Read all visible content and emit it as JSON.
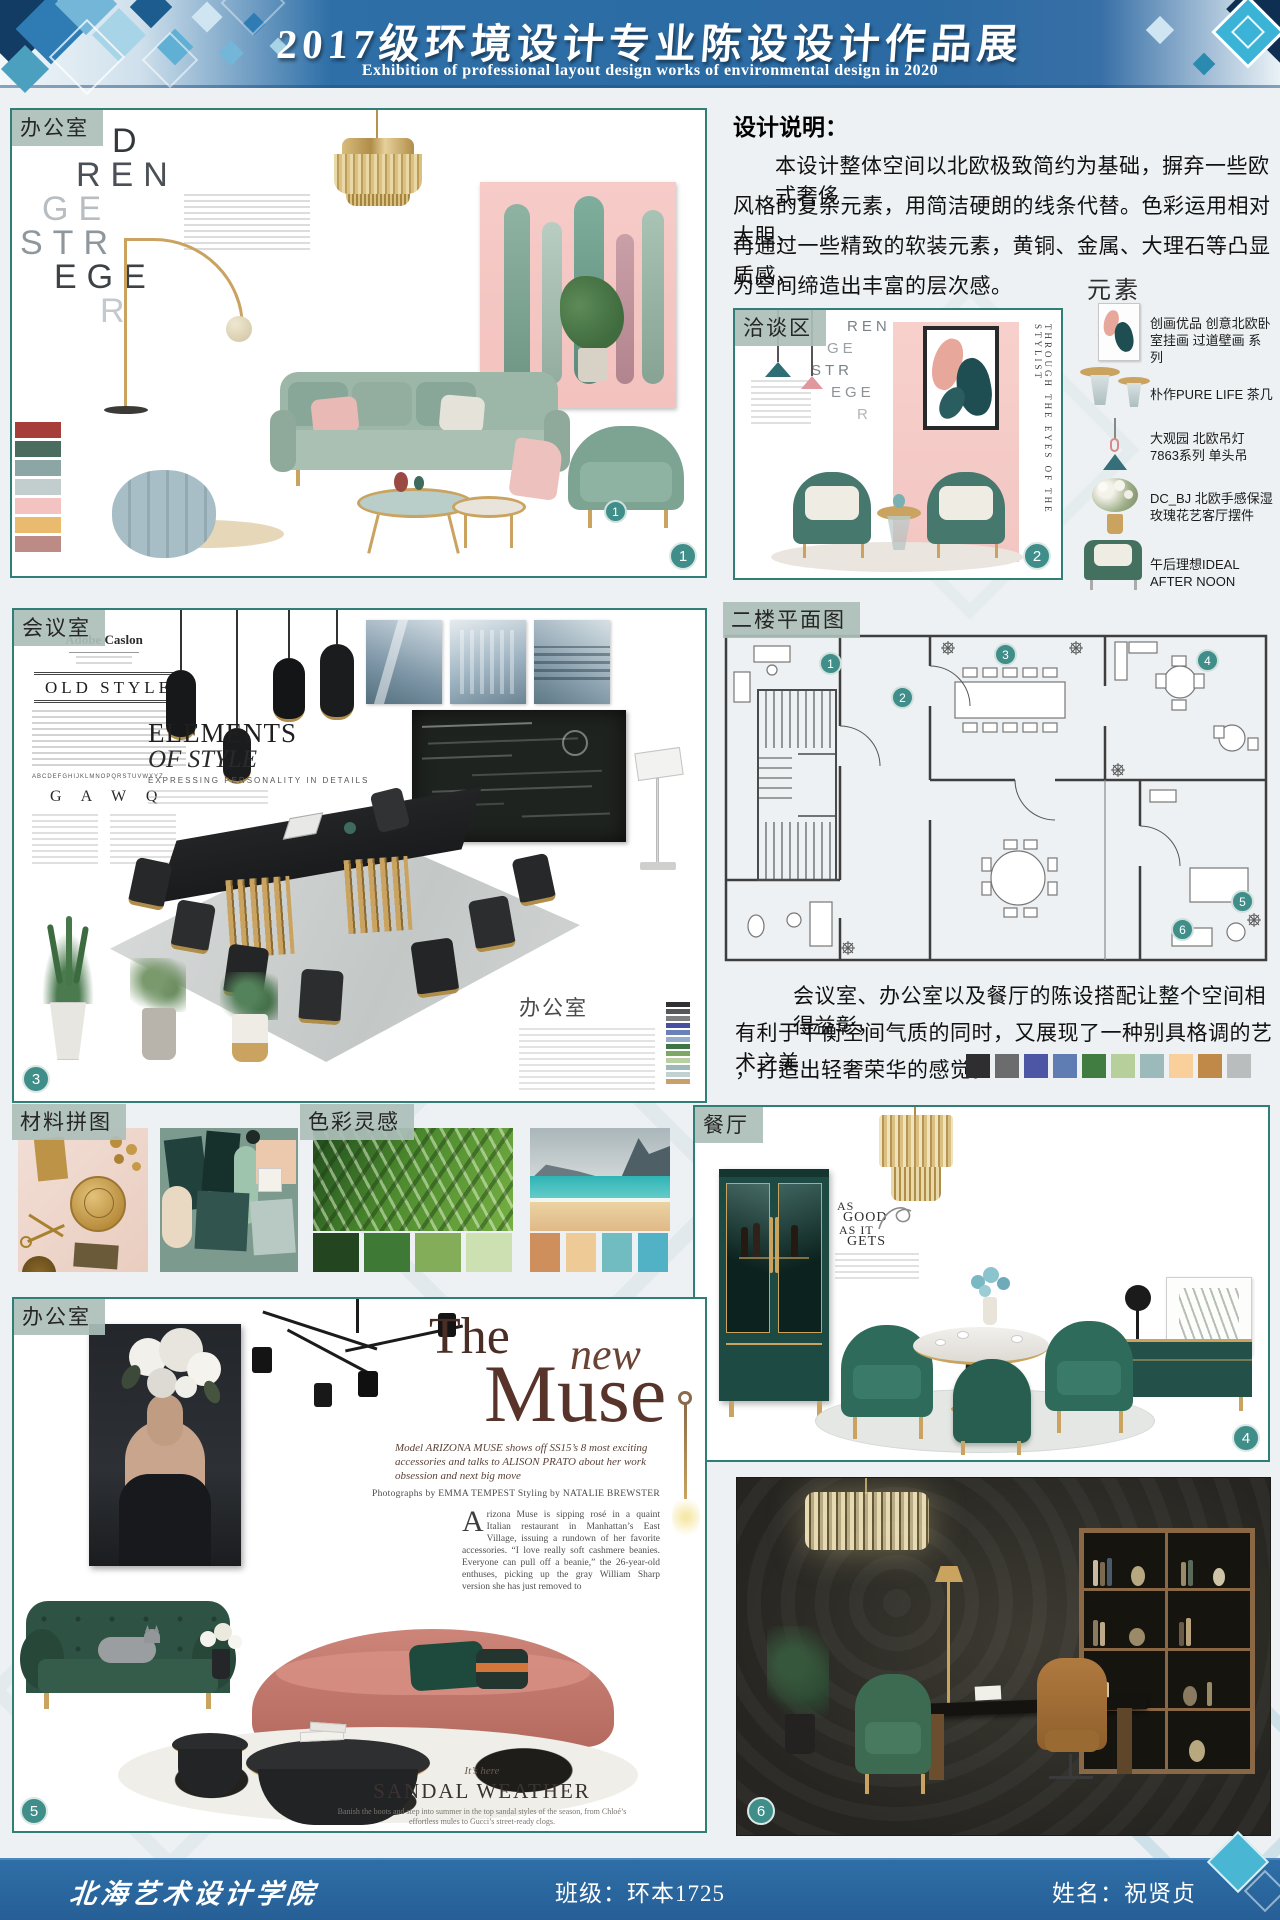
{
  "header": {
    "title": "2017级环境设计专业陈设设计作品展",
    "subtitle": "Exhibition of professional layout design works of environmental design in 2020"
  },
  "design_note": {
    "title": "设计说明：",
    "line1": "本设计整体空间以北欧极致简约为基础，摒弃一些欧式奢侈",
    "line2": "风格的复杂元素，用简洁硬朗的线条代替。色彩运用相对大胆，",
    "line3": "再通过一些精致的软装元素，黄铜、金属、大理石等凸显质感，",
    "line4": "为空间缔造出丰富的层次感。"
  },
  "office_top": {
    "label": "办公室",
    "badge": "1",
    "marker": "1",
    "letters": [
      "D",
      "REN",
      "GE",
      "STR",
      "EGE",
      "R"
    ],
    "palette": [
      "#a63d38",
      "#4b6d5f",
      "#8ba6a4",
      "#c2cecd",
      "#f2c3c1",
      "#eaba6e",
      "#bd8b85"
    ]
  },
  "negotiation": {
    "label": "洽谈区",
    "badge": "2",
    "letters": [
      "REN",
      "GE",
      "STR",
      "EGE",
      "R"
    ],
    "caption": "THROUGH THE EYES OF THE STYLIST"
  },
  "elements": {
    "title": "元素",
    "items": [
      {
        "name": "创画优品 创意北欧卧室挂画 过道壁画 系列"
      },
      {
        "name": "朴作PURE LIFE 茶几"
      },
      {
        "name": "大观园 北欧吊灯 7863系列 单头吊"
      },
      {
        "name": "DC_BJ 北欧手感保湿玫瑰花艺客厅摆件"
      },
      {
        "name": "午后理想IDEAL AFTER NOON"
      }
    ]
  },
  "meeting": {
    "label": "会议室",
    "badge": "3",
    "brand": "Adobe Caslon",
    "headline": "OLD STYLE",
    "specimen": "G A W Q",
    "alphabet": "ABCDEFGHIJKLMNOPQRSTUVWXYZ",
    "elements_line1": "ELEMENTS",
    "elements_line2": "OF STYLE",
    "elements_sub": "EXPRESSING PERSONALITY IN DETAILS",
    "inner_label": "办公室",
    "palette": [
      "#2f3133",
      "#55585a",
      "#7c8082",
      "#474fa0",
      "#6a82b6",
      "#95aecb",
      "#3f7447",
      "#7fa868",
      "#b9d0a2",
      "#9fb9b9",
      "#c2d2d2",
      "#c9a06a"
    ]
  },
  "floor_plan": {
    "label": "二楼平面图",
    "markers": [
      "1",
      "2",
      "3",
      "4",
      "5",
      "6"
    ]
  },
  "plan_note": {
    "line1": "会议室、办公室以及餐厅的陈设搭配让整个空间相得益彰，",
    "line2": "有利于平衡空间气质的同时，又展现了一种别具格调的艺术之美",
    "line3": "，打造出轻奢荣华的感觉。",
    "palette": [
      "#2e2e30",
      "#6c6c6e",
      "#4d55a5",
      "#5f7db3",
      "#417c41",
      "#b7cf9a",
      "#9dbaba",
      "#f9cf9c",
      "#c08948",
      "#b9bdbd"
    ]
  },
  "materials": {
    "label": "材料拼图"
  },
  "color_inspiration": {
    "label": "色彩灵感",
    "green_palette": [
      "#234621",
      "#3e7a35",
      "#83ad58",
      "#cde0b2"
    ],
    "beach_palette": [
      "#cf8f5c",
      "#eecb96",
      "#70bcc0",
      "#52b2c5"
    ]
  },
  "dining": {
    "label": "餐厅",
    "badge": "4",
    "headline": [
      "AS",
      "GOOD",
      "AS IT",
      "GETS"
    ]
  },
  "office_bottom": {
    "label": "办公室",
    "badge": "5",
    "title_the": "The",
    "title_new": "new",
    "title_muse": "Muse",
    "subtitle": "Model ARIZONA MUSE shows off SS15’s 8 most exciting accessories and talks to ALISON PRATO about her work obsession and next big move",
    "credits": "Photographs by EMMA TEMPEST   Styling by NATALIE BREWSTER",
    "dropcap": "A",
    "body": "rizona Muse is sipping rosé in a quaint Italian restaurant in Manhattan’s East Village, issuing a rundown of her favorite accessories. “I love really soft cashmere beanies. Everyone can pull off a beanie,” the 26-year-old enthuses, picking up the gray William Sharp version she has just removed to",
    "its_here": "It’s here",
    "sandal_title": "SANDAL WEATHER",
    "sandal_caption": "Banish the boots and step into summer in the top sandal styles of the season, from Chloé’s effortless mules to Gucci’s street-ready clogs."
  },
  "dark_office": {
    "badge": "6"
  },
  "footer": {
    "school": "北海艺术设计学院",
    "class_info": "班级：环本1725",
    "name_info": "姓名：祝贤贞"
  }
}
